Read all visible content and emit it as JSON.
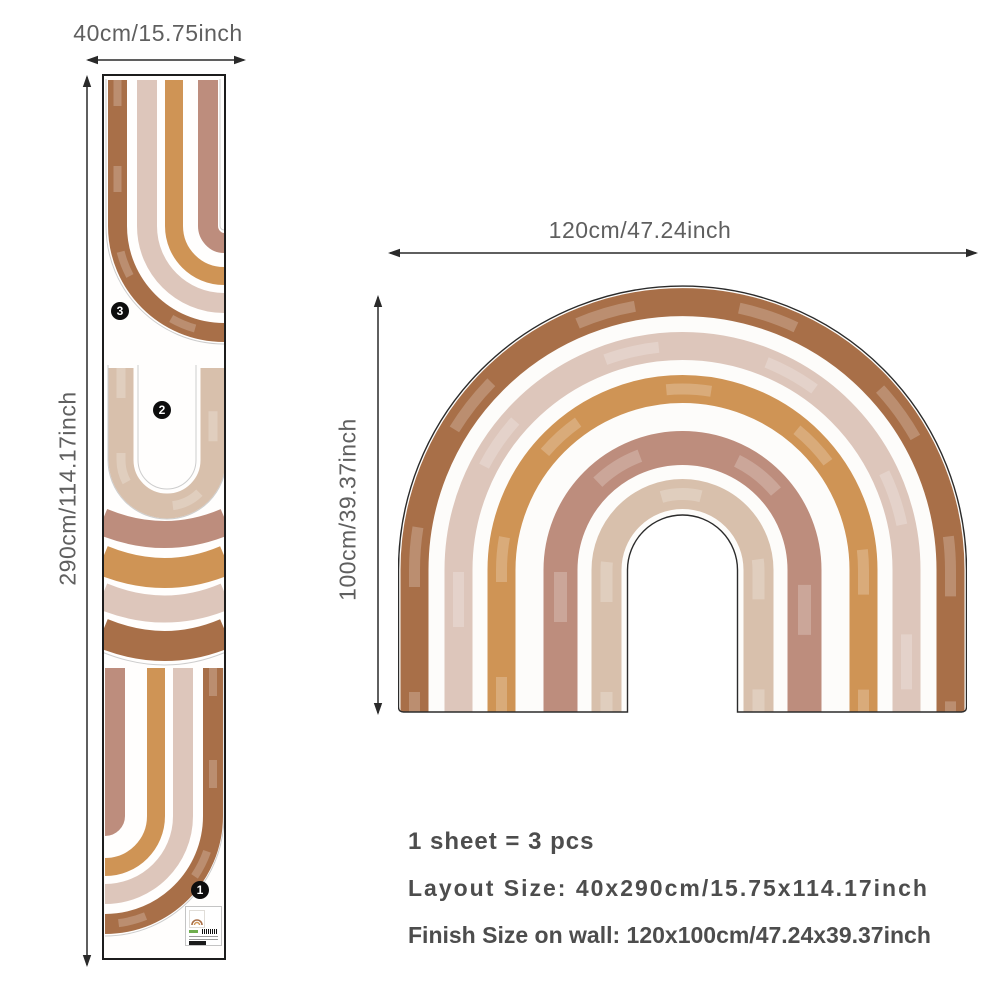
{
  "colors": {
    "brown": "#a86f48",
    "blush": "#ddc6bb",
    "orange": "#cf9455",
    "mauve": "#bd8d7d",
    "beige": "#d8c0ac",
    "outline": "#2b2b2b",
    "diecut": "#cdcdcd"
  },
  "sheet": {
    "width_label": "40cm/15.75inch",
    "height_label": "290cm/114.17inch",
    "pieces": [
      {
        "number": "1"
      },
      {
        "number": "2"
      },
      {
        "number": "3"
      }
    ]
  },
  "wall": {
    "width_label": "120cm/47.24inch",
    "height_label": "100cm/39.37inch"
  },
  "info": {
    "sheet_count": "1 sheet = 3 pcs",
    "layout_size": "Layout Size: 40x290cm/15.75x114.17inch",
    "finish_size": "Finish Size on wall: 120x100cm/47.24x39.37inch"
  }
}
